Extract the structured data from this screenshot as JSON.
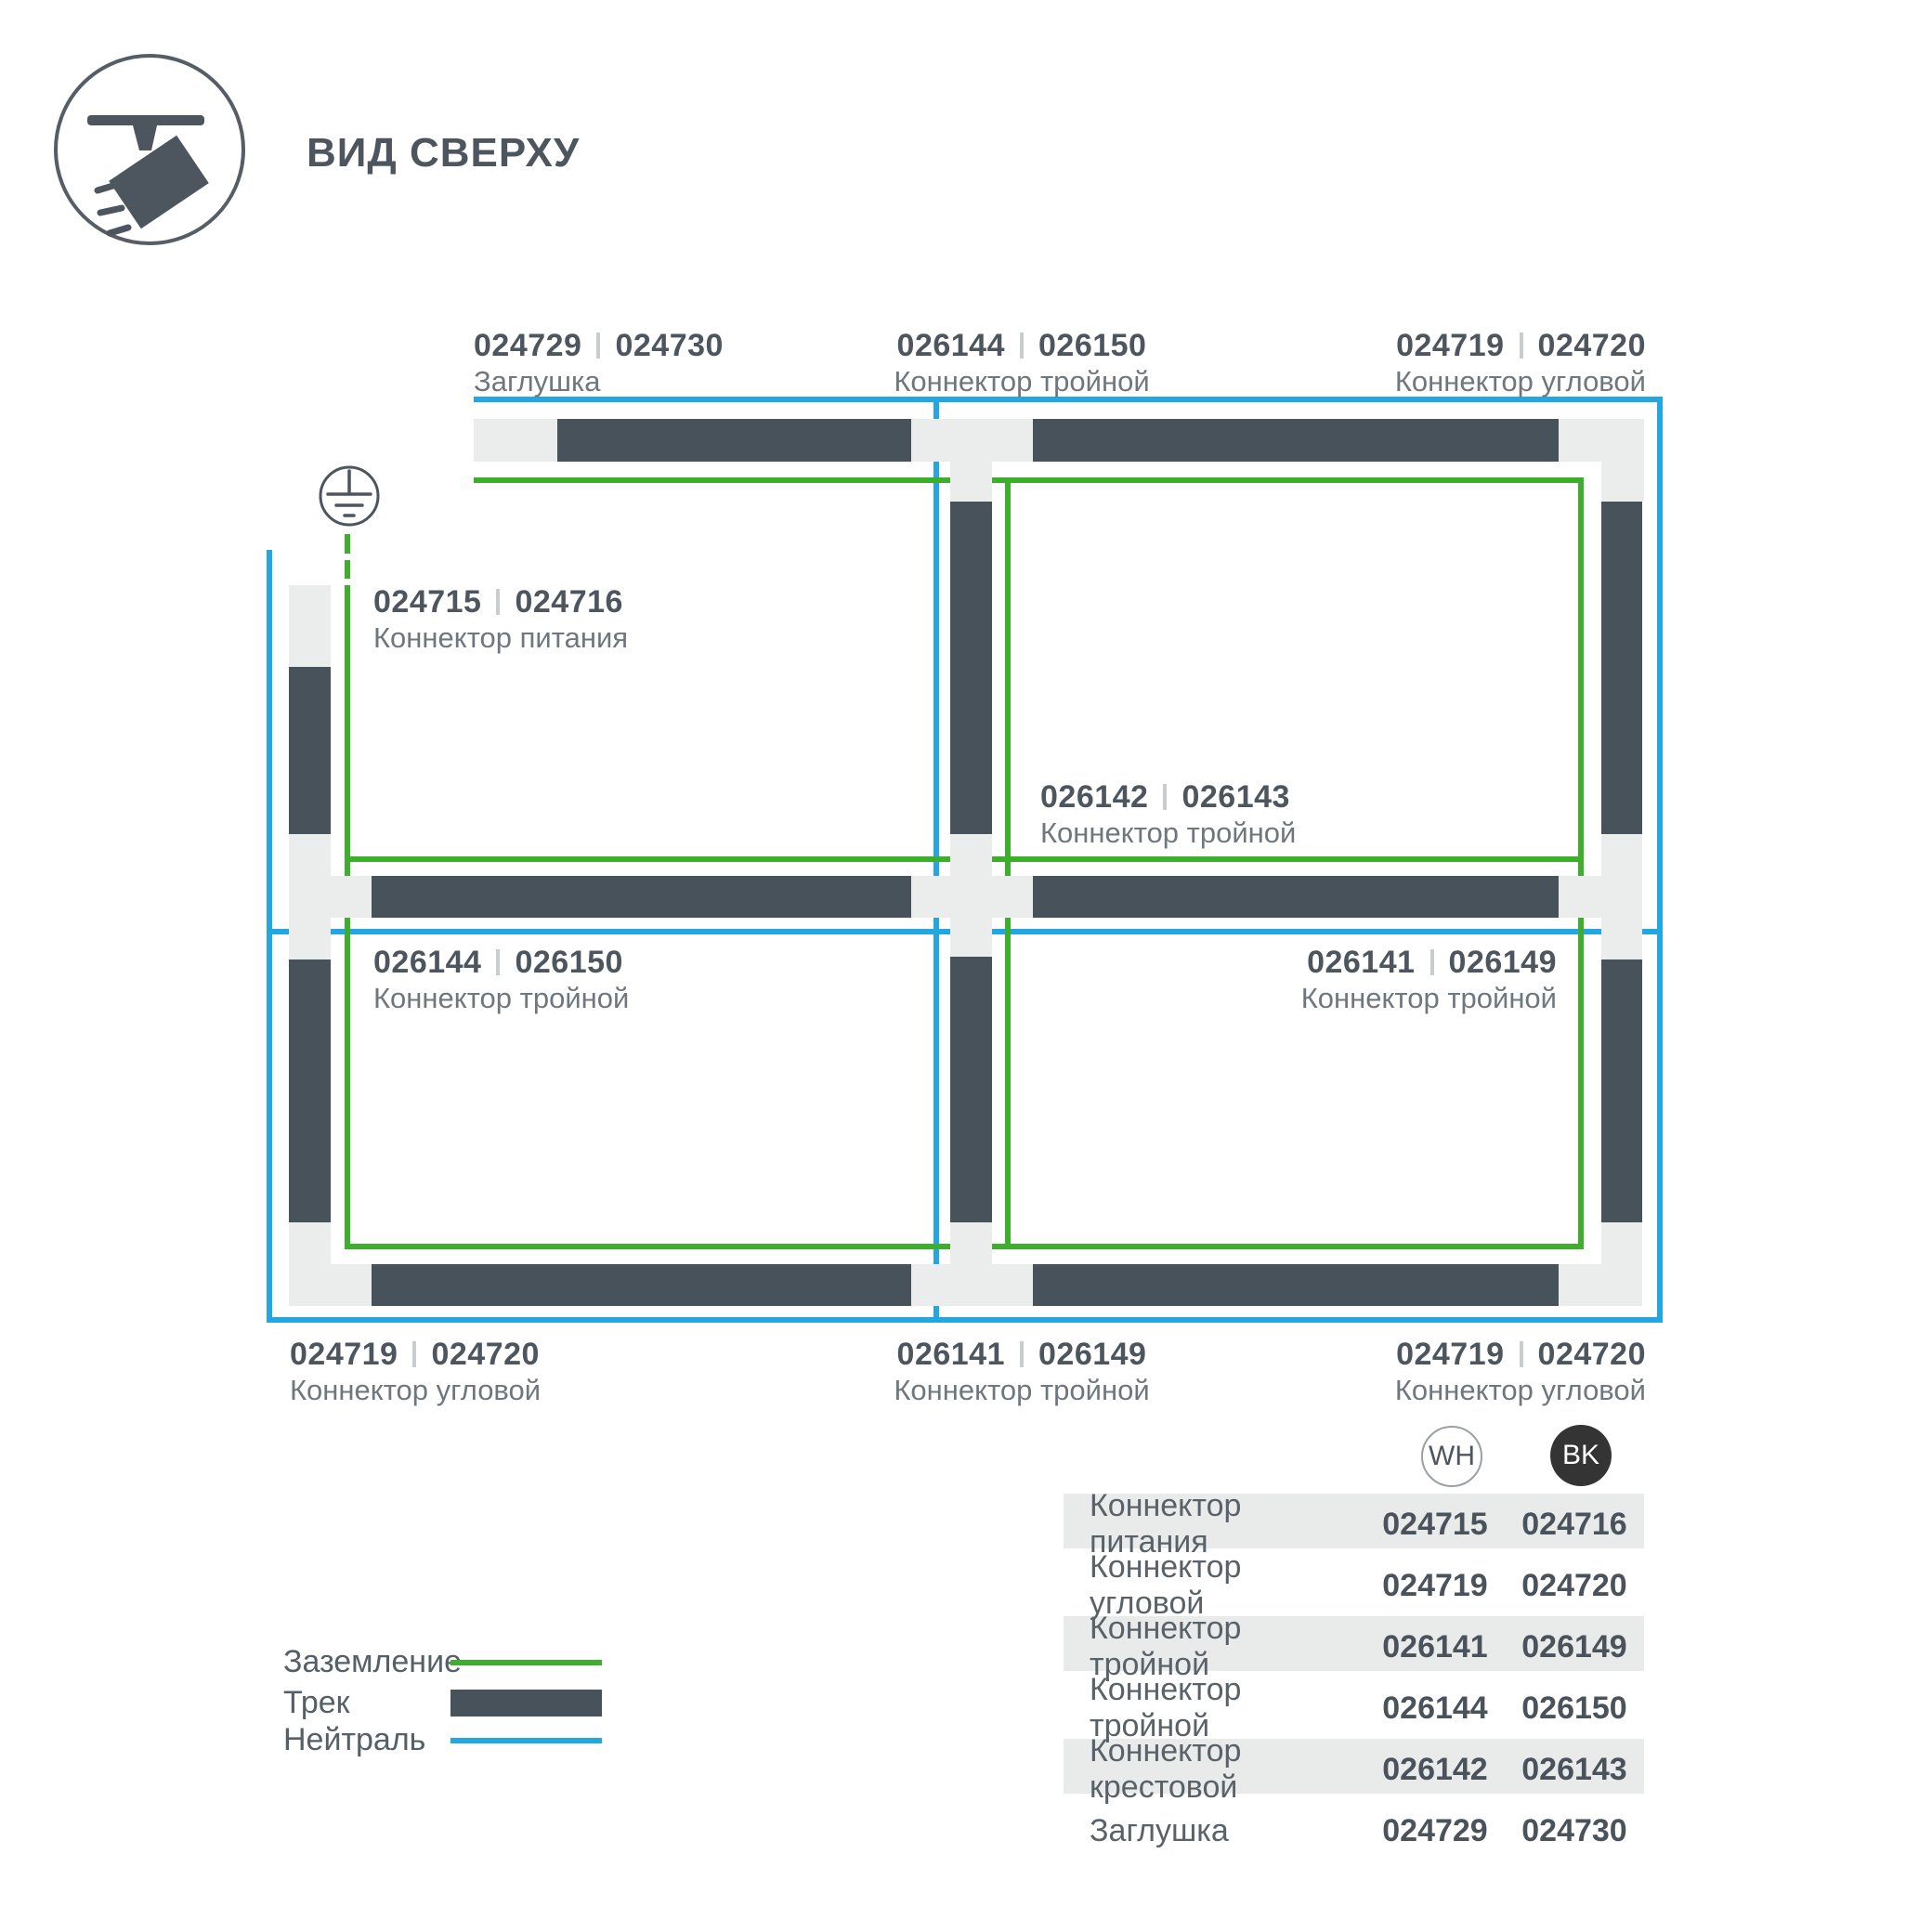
{
  "header": {
    "title": "ВИД СВЕРХУ"
  },
  "colors": {
    "ground_green": "#3eae2d",
    "neutral_blue": "#22a7e0",
    "track_dark": "#48525b",
    "connector_light": "#eaedec",
    "text_dark": "#4d565e",
    "text_light": "#6f777e"
  },
  "diagram_labels": [
    {
      "id": "cap-top",
      "wh": "024729",
      "bk": "024730",
      "name": "Заглушка"
    },
    {
      "id": "t-top",
      "wh": "026144",
      "bk": "026150",
      "name": "Коннектор тройной"
    },
    {
      "id": "corner-top-right",
      "wh": "024719",
      "bk": "024720",
      "name": "Коннектор угловой"
    },
    {
      "id": "power",
      "wh": "024715",
      "bk": "024716",
      "name": "Коннектор питания"
    },
    {
      "id": "cross-center",
      "wh": "026142",
      "bk": "026143",
      "name": "Коннектор тройной"
    },
    {
      "id": "t-left",
      "wh": "026144",
      "bk": "026150",
      "name": "Коннектор тройной"
    },
    {
      "id": "t-right",
      "wh": "026141",
      "bk": "026149",
      "name": "Коннектор тройной"
    },
    {
      "id": "corner-bottom-left",
      "wh": "024719",
      "bk": "024720",
      "name": "Коннектор угловой"
    },
    {
      "id": "t-bottom",
      "wh": "026141",
      "bk": "026149",
      "name": "Коннектор тройной"
    },
    {
      "id": "corner-bottom-right",
      "wh": "024719",
      "bk": "024720",
      "name": "Коннектор угловой"
    }
  ],
  "legend": [
    {
      "label": "Заземление",
      "type": "ground-green-line"
    },
    {
      "label": "Трек",
      "type": "track-dark-bar"
    },
    {
      "label": "Нейтраль",
      "type": "neutral-blue-line"
    }
  ],
  "chips": {
    "wh": "WH",
    "bk": "BK"
  },
  "table": {
    "rows": [
      {
        "name": "Коннектор питания",
        "wh": "024715",
        "bk": "024716"
      },
      {
        "name": "Коннектор угловой",
        "wh": "024719",
        "bk": "024720"
      },
      {
        "name": "Коннектор тройной",
        "wh": "026141",
        "bk": "026149"
      },
      {
        "name": "Коннектор тройной",
        "wh": "026144",
        "bk": "026150"
      },
      {
        "name": "Коннектор крестовой",
        "wh": "026142",
        "bk": "026143"
      },
      {
        "name": "Заглушка",
        "wh": "024729",
        "bk": "024730"
      }
    ]
  }
}
